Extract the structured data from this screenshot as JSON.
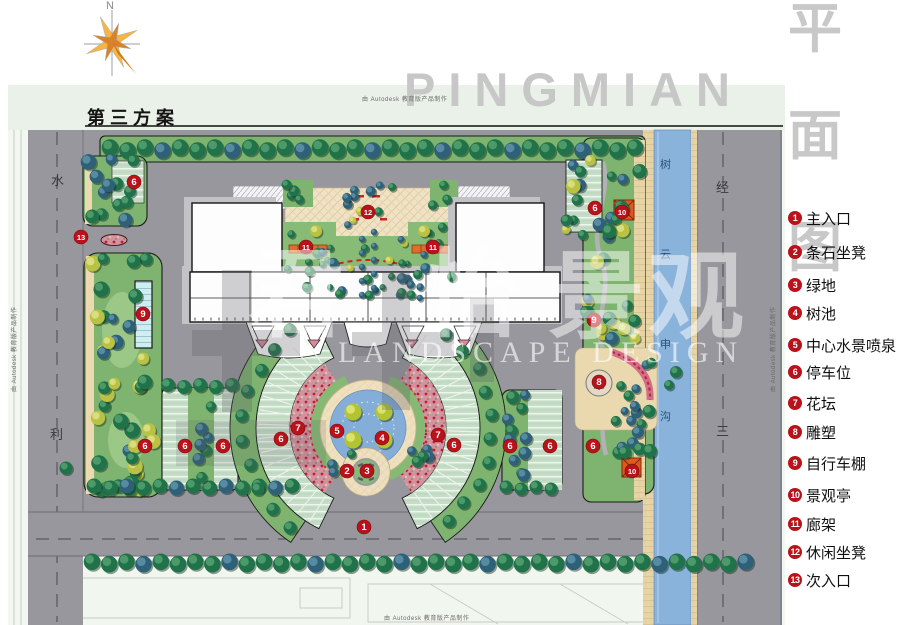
{
  "title": "第三方案",
  "compass": {
    "label": "N"
  },
  "watermarks": {
    "big_latin": "PINGMIAN",
    "vertical_cn": [
      "平",
      "面",
      "图"
    ],
    "brand_cn": [
      "君",
      "怡",
      "景",
      "观"
    ],
    "brand_latin": "LANDSCAPE DESIGN",
    "autodesk": "由 Autodesk 教育版产品制作"
  },
  "roads": {
    "left": [
      "水",
      "利"
    ],
    "right": [
      "经",
      "三"
    ]
  },
  "river": [
    "树",
    "云",
    "申",
    "沟"
  ],
  "legend": {
    "items": [
      {
        "num": "1",
        "label": "主入口"
      },
      {
        "num": "2",
        "label": "条石坐凳"
      },
      {
        "num": "3",
        "label": "绿地"
      },
      {
        "num": "4",
        "label": "树池"
      },
      {
        "num": "5",
        "label": "中心水景喷泉"
      },
      {
        "num": "6",
        "label": "停车位"
      },
      {
        "num": "7",
        "label": "花坛"
      },
      {
        "num": "8",
        "label": "雕塑"
      },
      {
        "num": "9",
        "label": "自行车棚"
      },
      {
        "num": "10",
        "label": "景观亭"
      },
      {
        "num": "11",
        "label": "廊架"
      },
      {
        "num": "12",
        "label": "休闲坐凳"
      },
      {
        "num": "13",
        "label": "次入口"
      }
    ]
  },
  "badges": [
    {
      "n": "1",
      "x": 364,
      "y": 527
    },
    {
      "n": "2",
      "x": 347,
      "y": 471
    },
    {
      "n": "3",
      "x": 367,
      "y": 471
    },
    {
      "n": "4",
      "x": 382,
      "y": 438
    },
    {
      "n": "5",
      "x": 337,
      "y": 431
    },
    {
      "n": "6",
      "x": 134,
      "y": 182
    },
    {
      "n": "6",
      "x": 595,
      "y": 208
    },
    {
      "n": "6",
      "x": 145,
      "y": 446
    },
    {
      "n": "6",
      "x": 185,
      "y": 446
    },
    {
      "n": "6",
      "x": 223,
      "y": 446
    },
    {
      "n": "6",
      "x": 281,
      "y": 439
    },
    {
      "n": "6",
      "x": 454,
      "y": 445
    },
    {
      "n": "6",
      "x": 510,
      "y": 446
    },
    {
      "n": "6",
      "x": 550,
      "y": 446
    },
    {
      "n": "6",
      "x": 593,
      "y": 446
    },
    {
      "n": "7",
      "x": 298,
      "y": 428
    },
    {
      "n": "7",
      "x": 438,
      "y": 435
    },
    {
      "n": "8",
      "x": 599,
      "y": 382
    },
    {
      "n": "9",
      "x": 143,
      "y": 314
    },
    {
      "n": "9",
      "x": 594,
      "y": 320
    },
    {
      "n": "10",
      "x": 622,
      "y": 212
    },
    {
      "n": "10",
      "x": 632,
      "y": 471
    },
    {
      "n": "11",
      "x": 306,
      "y": 247
    },
    {
      "n": "11",
      "x": 433,
      "y": 247
    },
    {
      "n": "12",
      "x": 368,
      "y": 212
    },
    {
      "n": "13",
      "x": 81,
      "y": 237
    }
  ],
  "colors": {
    "badge_red": "#b9121a",
    "road_gray": "#97979d",
    "lawn_green": "#7eb46f",
    "river_blue": "#8ab3dc",
    "plaza_cream": "#f0e2c4",
    "pergola_orange": "#df6e2c",
    "bank_sand": "#e7d5a8"
  }
}
